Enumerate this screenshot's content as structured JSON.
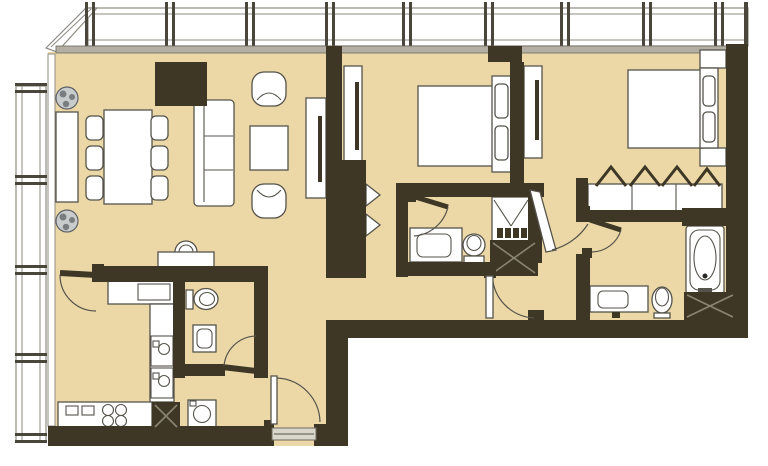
{
  "title": "Apartment floor plan",
  "canvas": {
    "width": 768,
    "height": 466
  },
  "colors": {
    "paper": "#ffffff",
    "floor": "#ecd8a6",
    "wall": "#3e3726",
    "line": "#55534b",
    "glassline": "#8e8b82",
    "sill": "#b3afa4",
    "fixture": "#ffffff",
    "hatch": "#8a8473",
    "plant": "#c9cccd",
    "plantdark": "#787d80",
    "threshold": "#d9d6cc",
    "mullion": "#4a463c"
  },
  "rooms": [
    "living-dining-room",
    "kitchen",
    "guest-wc",
    "entry-foyer",
    "hallway",
    "corridor",
    "bedroom-1",
    "bathroom-1",
    "bedroom-2",
    "master-closet",
    "master-bathroom"
  ],
  "fixtures": [
    "window-wall-top",
    "window-wall-left",
    "structural-column",
    "dining-table",
    "dining-chairs",
    "sofa",
    "coffee-table",
    "armchairs",
    "tv-console",
    "plants",
    "wall-console",
    "basin-console",
    "kitchen-counters",
    "cooktop",
    "kitchen-sink-units",
    "appliance-block",
    "washing-machine",
    "toilet-guest",
    "basin-guest",
    "entry-door",
    "wc-door",
    "kitchen-door",
    "wardrobe-cabinets",
    "closet-door-swings",
    "shower",
    "bathroom1-vanity",
    "bathroom1-toilet",
    "bathroom1-door",
    "bathroom1-cabinet",
    "hall-door",
    "suite-door",
    "bed-1",
    "headboard-1",
    "pillows-1",
    "tv-panel-bedroom1",
    "bed-2",
    "headboard-2",
    "pillows-2",
    "nightstands",
    "tv-panel-bedroom2",
    "hanger-rail-symbols",
    "master-closet-shelves",
    "master-bath-door",
    "master-vanity",
    "master-toilet",
    "bathtub",
    "master-bath-cabinet"
  ]
}
